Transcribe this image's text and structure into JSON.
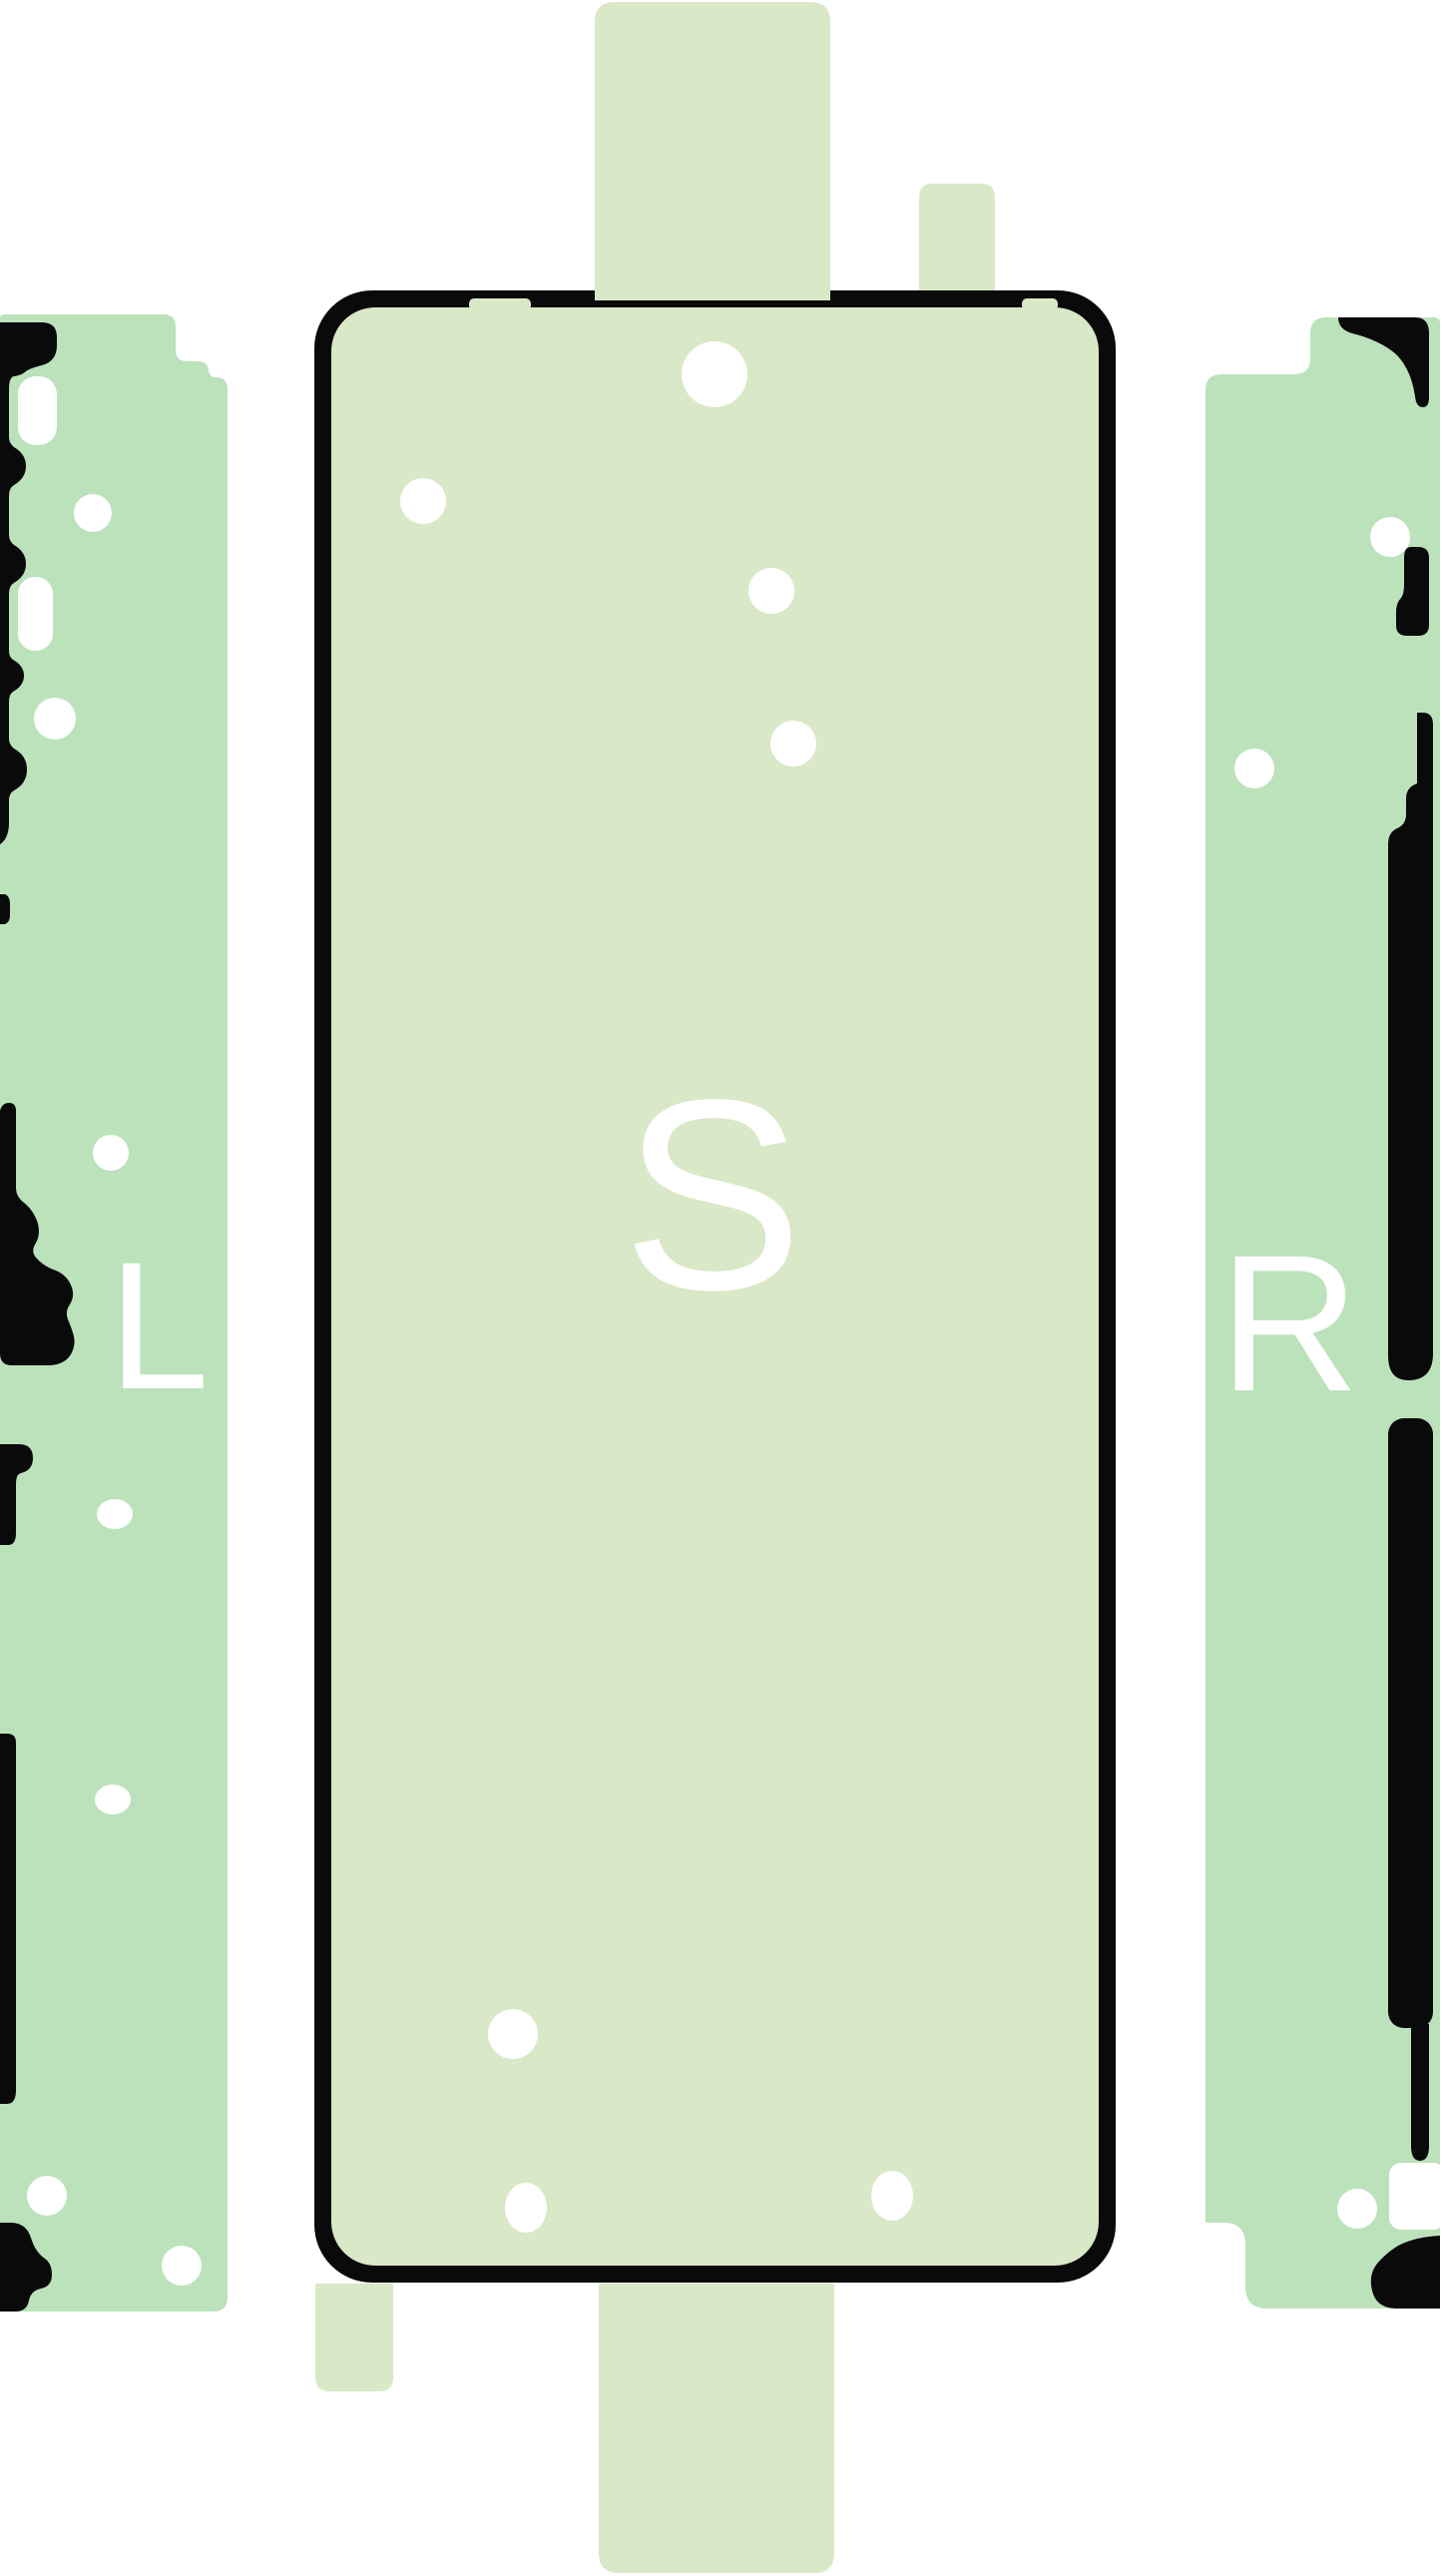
{
  "labels": {
    "left": "L",
    "screen": "S",
    "right": "R"
  },
  "colors": {
    "side_strip_green": "#bce2bb",
    "center_sheet_green": "#d9e8c6",
    "outline_black": "#0a0a0b",
    "hole_white": "#ffffff",
    "background_white": "#ffffff"
  }
}
